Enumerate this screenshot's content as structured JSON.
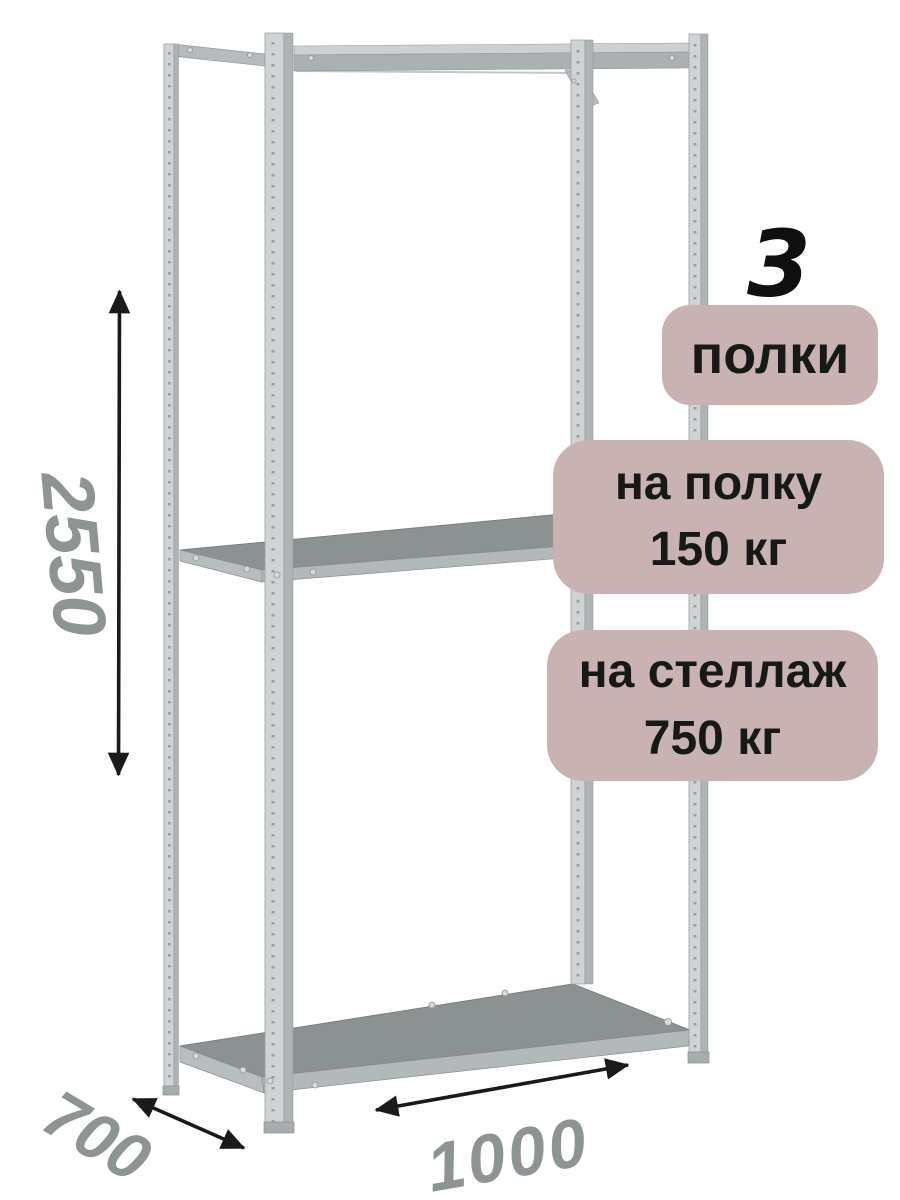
{
  "annotations": {
    "shelf_count": {
      "number": "3",
      "label": "полки"
    },
    "shelf_load": {
      "line1": "на полку",
      "line2": "150 кг"
    },
    "rack_load": {
      "line1": "на стеллаж",
      "line2": "750 кг"
    }
  },
  "dimensions": {
    "height_mm": "2550",
    "depth_mm": "700",
    "width_mm": "1000"
  },
  "illustration": {
    "subject": "metal boltless shelving rack, 4 perforated uprights, 3 shelves"
  },
  "colors": {
    "background": "#ffffff",
    "badge_fill": "#c9b2b2",
    "badge_text": "#161a16",
    "count_text": "#0f0f0f",
    "dimension_text": "#8e9393",
    "arrow": "#1a1a1a",
    "metal_light": "#cfd3d4",
    "metal_face": "#adb2b4",
    "metal_dark_face": "#b0b5b7",
    "shelf_top": "#8c9192",
    "shelf_edge": "#b3b8ba"
  }
}
